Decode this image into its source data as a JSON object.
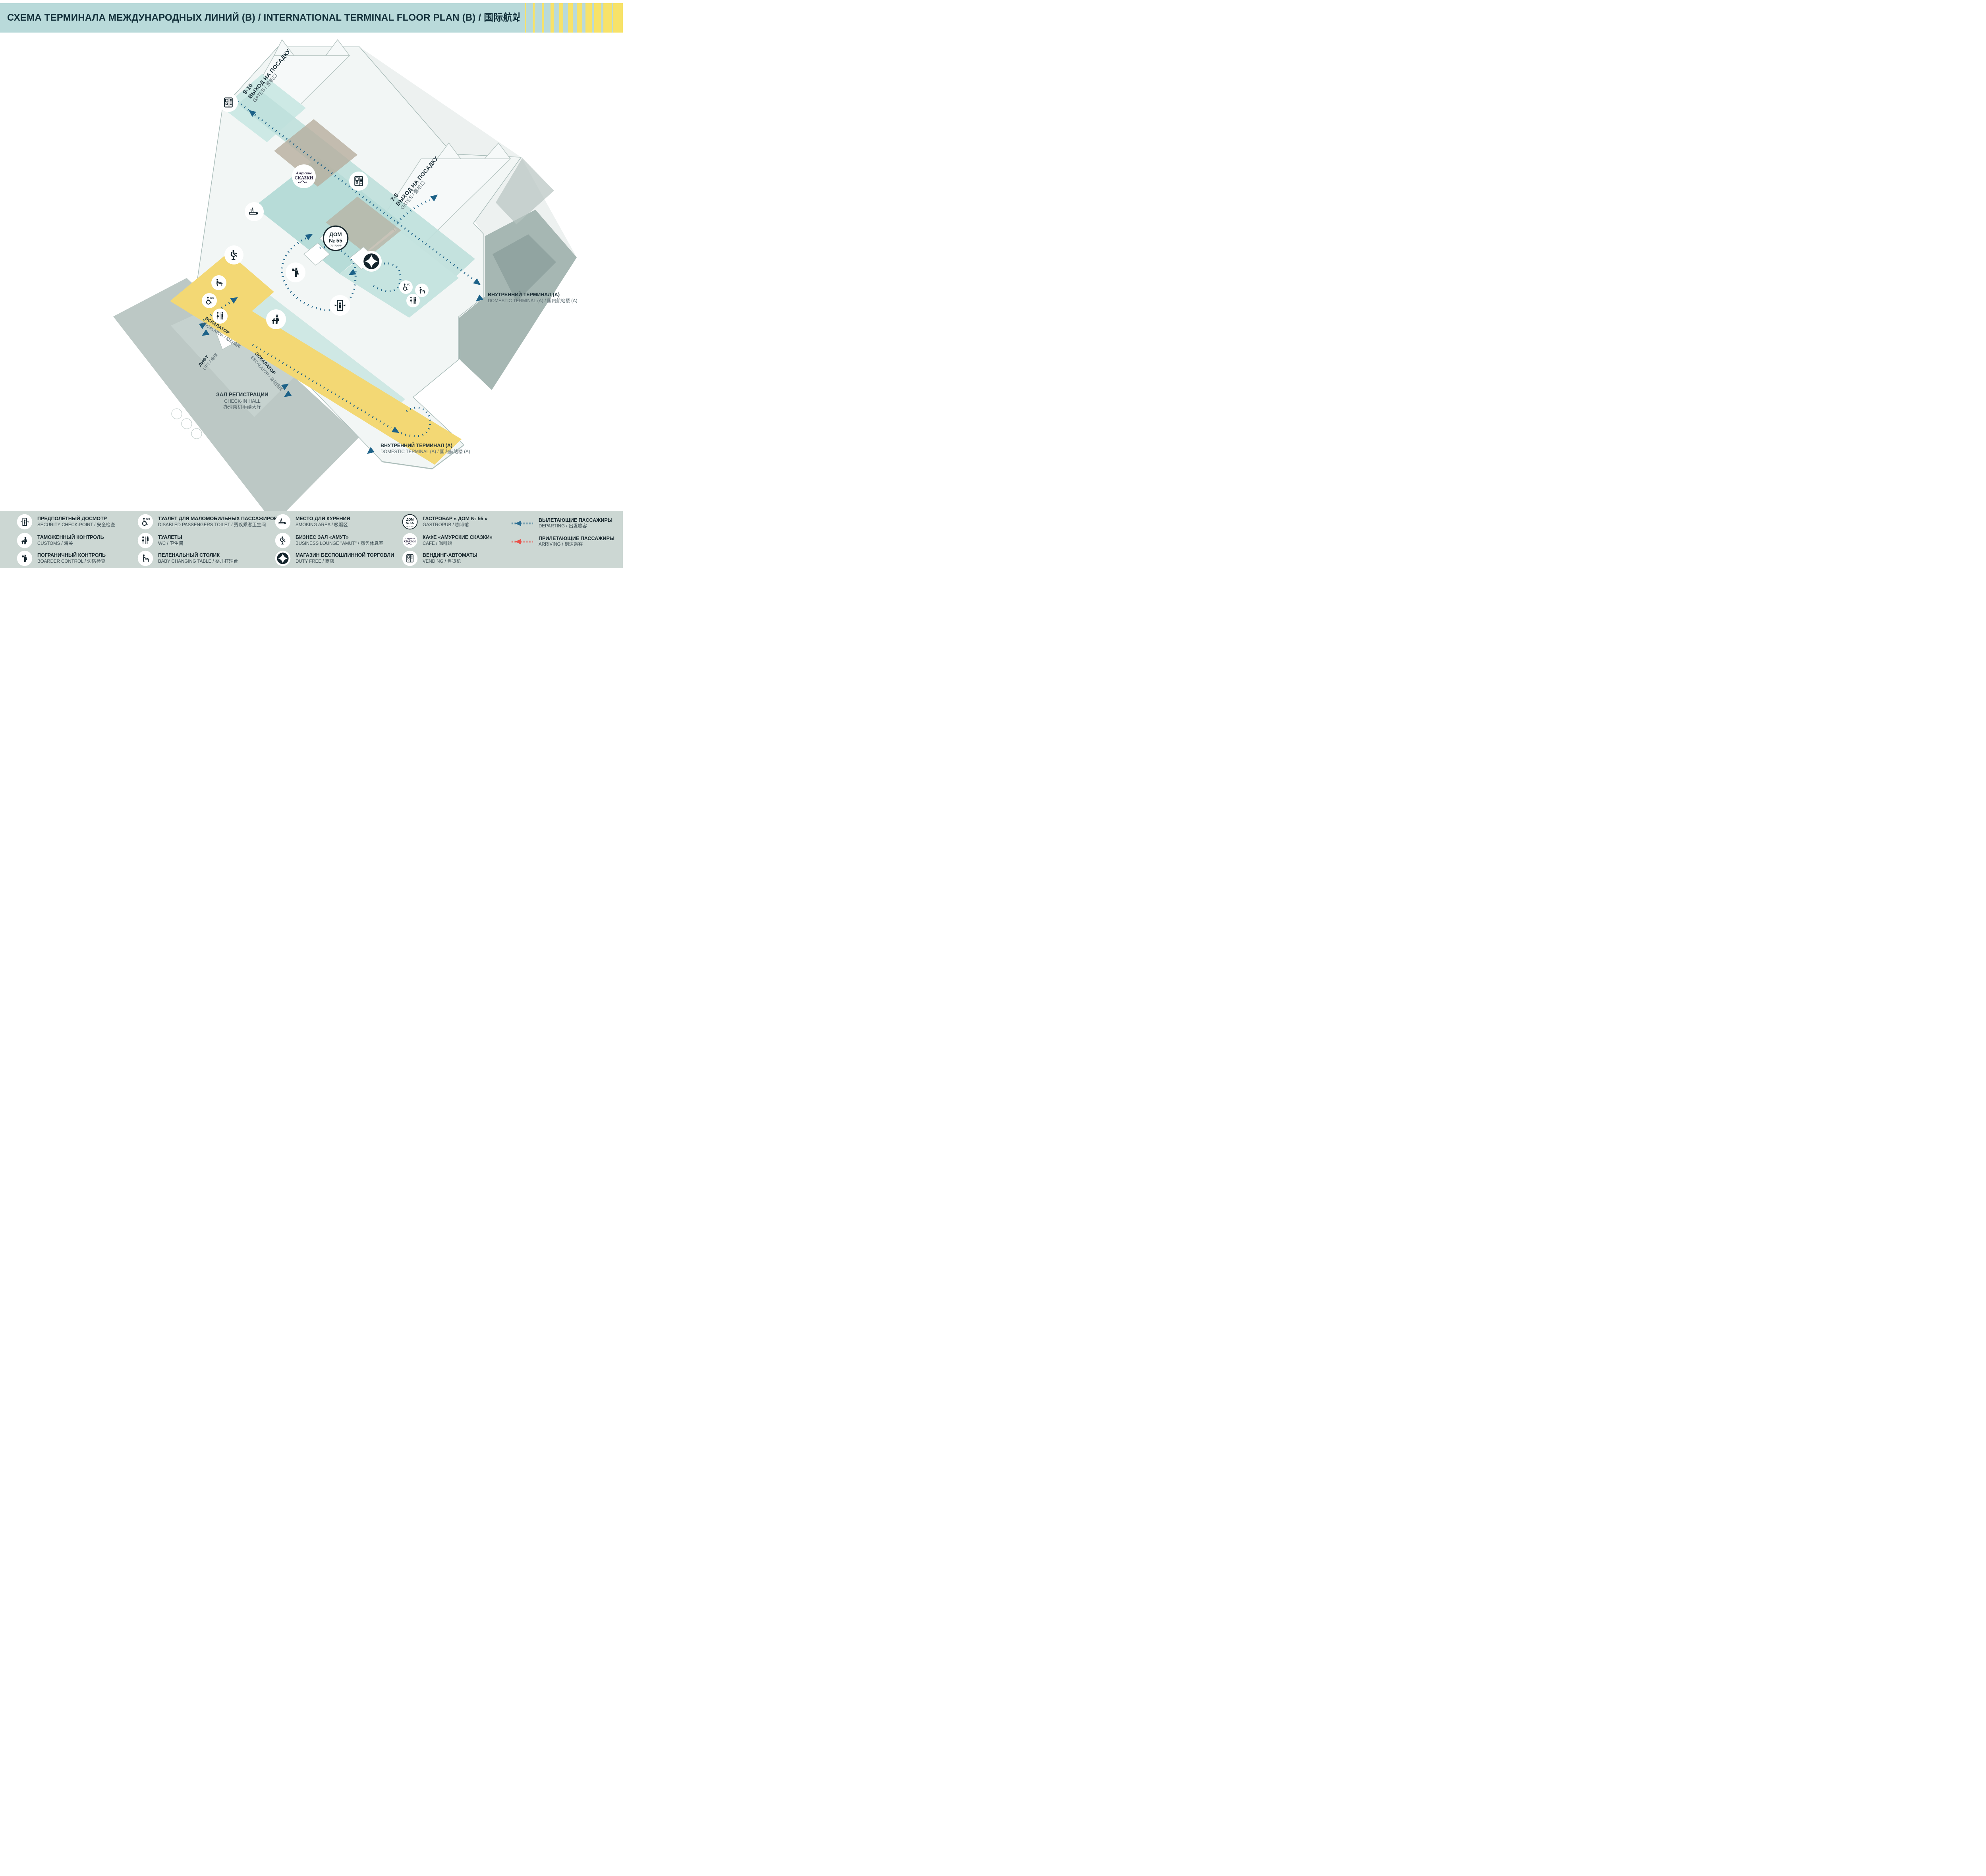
{
  "header": {
    "title": "СХЕМА ТЕРМИНАЛА МЕЖДУНАРОДНЫХ ЛИНИЙ (В) / INTERNATIONAL TERMINAL  FLOOR PLAN (B) / 国际航站楼平面图 (B)"
  },
  "map": {
    "gates_910": {
      "num": "9-10",
      "ru": "ВЫХОД НА ПОСАДКУ",
      "en": "GATES / 登机口"
    },
    "gates_78": {
      "num": "7-8",
      "ru": "ВЫХОД НА ПОСАДКУ",
      "en": "GATES / 登机口"
    },
    "domestic_right": {
      "ru": "ВНУТРЕННИЙ ТЕРМИНАЛ (А)",
      "en": "DOMESTIC TERMINAL (A) / 国内航站楼 (A)"
    },
    "domestic_bottom": {
      "ru": "ВНУТРЕННИЙ ТЕРМИНАЛ (А)",
      "en": "DOMESTIC TERMINAL (A) / 国内航站楼 (A)"
    },
    "checkin": {
      "ru": "ЗАЛ РЕГИСТРАЦИИ",
      "en": "CHECK-IN HALL",
      "zh": "办理乘机手续大厅"
    },
    "lift": {
      "ru": "ЛИФТ",
      "en": "LIFT / 电梯"
    },
    "escalator": {
      "ru": "ЭСКАЛАТОР",
      "en": "ESCALATOR / 自动扶梯"
    },
    "floor": {
      "bold": "ЭТАЖ 3",
      "rest": " / FLOOR 3 / 3楼"
    },
    "logo_dom55": {
      "l1": "ДОМ",
      "l2": "№ 55",
      "l3": "ГАСТРОБАР"
    },
    "logo_skazki": {
      "l1": "Амурские",
      "l2": "СКАЗКИ"
    }
  },
  "legend": {
    "items": [
      {
        "icon": "security-checkpoint",
        "ru": "ПРЕДПОЛЁТНЫЙ ДОСМОТР",
        "en": "SECURITY CHECK-POINT / 安全检查"
      },
      {
        "icon": "customs",
        "ru": "ТАМОЖЕННЫЙ КОНТРОЛЬ",
        "en": "CUSTOMS / 海关"
      },
      {
        "icon": "border-control",
        "ru": "ПОГРАНИЧНЫЙ КОНТРОЛЬ",
        "en": "BOARDER CONTROL / 边防检查"
      },
      {
        "icon": "disabled-toilet",
        "ru": "ТУАЛЕТ ДЛЯ МАЛОМОБИЛЬНЫХ ПАССАЖИРОВ",
        "en": "DISABLED PASSENGERS TOILET / 残疾乘客卫生间"
      },
      {
        "icon": "wc",
        "ru": "ТУАЛЕТЫ",
        "en": "WC / 卫生间"
      },
      {
        "icon": "baby-changing",
        "ru": "ПЕЛЕНАЛЬНЫЙ СТОЛИК",
        "en": "BABY CHANGING TABLE / 婴儿打理台"
      },
      {
        "icon": "smoking-area",
        "ru": "МЕСТО ДЛЯ КУРЕНИЯ",
        "en": "SMOKING AREA / 吸烟区"
      },
      {
        "icon": "business-lounge",
        "ru": "БИЗНЕС ЗАЛ «АМУТ»",
        "en": "BUSINESS LOUNGE \"AMUT\" / 商务休息室"
      },
      {
        "icon": "duty-free",
        "ru": "МАГАЗИН БЕСПОШЛИННОЙ ТОРГОВЛИ",
        "en": "DUTY FREE / 商店"
      },
      {
        "icon": "gastropub-dom55",
        "ru": "ГАСТРОБАР « ДОМ № 55 »",
        "en": "GASTROPUB / 咖啡馆"
      },
      {
        "icon": "cafe-skazki",
        "ru": "КАФЕ «АМУРСКИЕ СКАЗКИ»",
        "en": "CAFE / 咖啡馆"
      },
      {
        "icon": "vending",
        "ru": "ВЕНДИНГ-АВТОМАТЫ",
        "en": "VENDING / 售货机"
      }
    ],
    "flows": [
      {
        "ru": "ВЫЛЕТАЮЩИЕ ПАССАЖИРЫ",
        "en": "DEPARTING / 出发旅客",
        "color": "#2b6d92"
      },
      {
        "ru": "ПРИЛЕТАЮЩИЕ ПАССАЖИРЫ",
        "en": "ARRIVING / 到达乘客",
        "color": "#ea5149"
      }
    ]
  },
  "colors": {
    "header_bg": "#b9dada",
    "stripe_yellow": "#f7e269",
    "checkin_yellow": "#f3d874",
    "floor_teal": "#bfe0dc",
    "path_blue": "#1d6288",
    "arriving_red": "#ea5149",
    "legend_bg": "#ccd7d3",
    "ink": "#16262e"
  }
}
